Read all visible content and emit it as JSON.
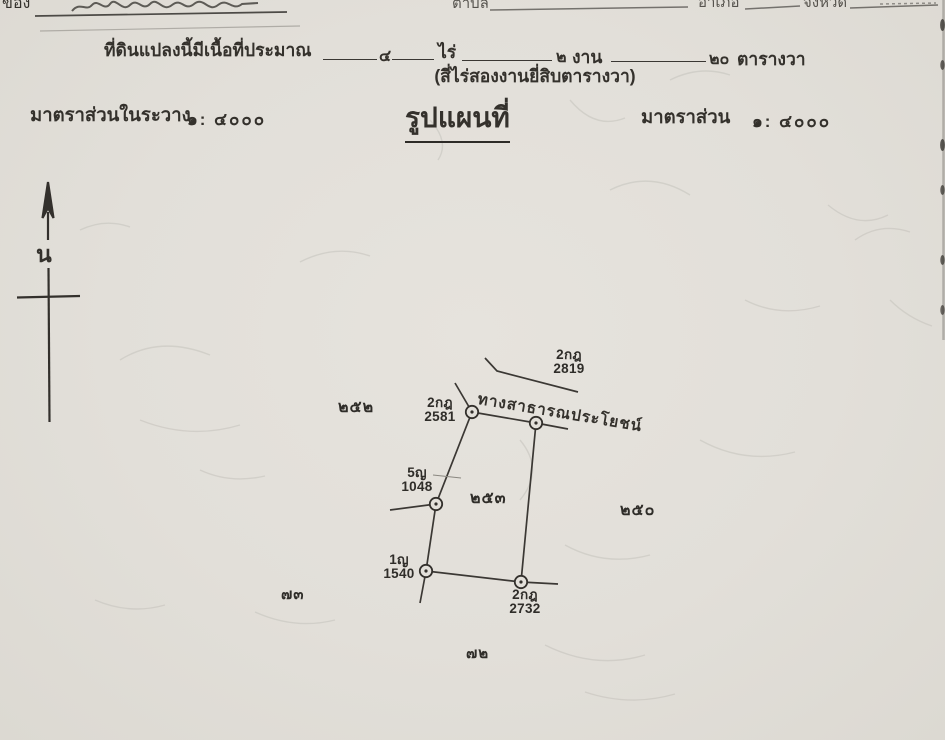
{
  "header": {
    "owner_label": "ของ",
    "subdistrict_label": "ตำบล",
    "district_label": "อำเภอ",
    "province_label": "จังหวัด"
  },
  "area": {
    "prefix": "ที่ดินแปลงนี้มีเนื้อที่ประมาณ",
    "rai_value": "๔",
    "rai_unit": "ไร่",
    "ngan_value": "๒",
    "ngan_unit": "งาน",
    "wa_value": "๒๐",
    "wa_unit": "ตารางวา",
    "words": "(สี่ไร่สองงานยี่สิบตารางวา)"
  },
  "scales": {
    "left_label": "มาตราส่วนในระวาง",
    "left_value": "๑: ๔๐๐๐",
    "map_title": "รูปแผนที่",
    "right_label": "มาตราส่วน",
    "right_value": "๑: ๔๐๐๐"
  },
  "compass": {
    "north_label": "น"
  },
  "map": {
    "road_label": "ทางสาธารณประโยชน์",
    "survey_points": [
      {
        "code": "2กฎ",
        "number": "2819"
      },
      {
        "code": "2กฎ",
        "number": "2581"
      },
      {
        "code": "5ญ",
        "number": "1048"
      },
      {
        "code": "1ญ",
        "number": "1540"
      },
      {
        "code": "2กฎ",
        "number": "2732"
      }
    ],
    "adjacent_parcel_numbers": [
      "๒๕๒",
      "๒๕๓",
      "๒๕๐",
      "๗๓",
      "๗๒"
    ]
  },
  "colors": {
    "paper": "#e3e0da",
    "ink": "#34312c",
    "map_line": "#3b3834"
  }
}
